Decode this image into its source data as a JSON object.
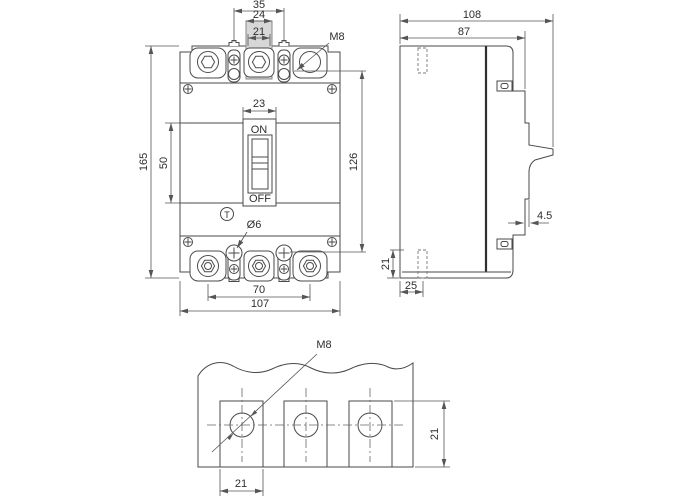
{
  "front_view": {
    "dim_terminal_pitch": "35",
    "dim_tab_outer": "24",
    "dim_tab_inner": "21",
    "thread_label": "M8",
    "dim_switch_width": "23",
    "dim_panel_height": "50",
    "dim_height": "165",
    "dim_mount_span": "126",
    "hole_label": "Ø6",
    "dim_pole_span": "70",
    "dim_width": "107",
    "switch_on": "ON",
    "switch_off": "OFF",
    "trip_button": "T"
  },
  "side_view": {
    "dim_depth_total": "108",
    "dim_depth_body": "87",
    "dim_handle_step": "4.5",
    "dim_base_height": "21",
    "dim_slot_offset": "25"
  },
  "detail_view": {
    "thread_label": "M8",
    "dim_pad_height": "21",
    "dim_pad_width": "21"
  }
}
